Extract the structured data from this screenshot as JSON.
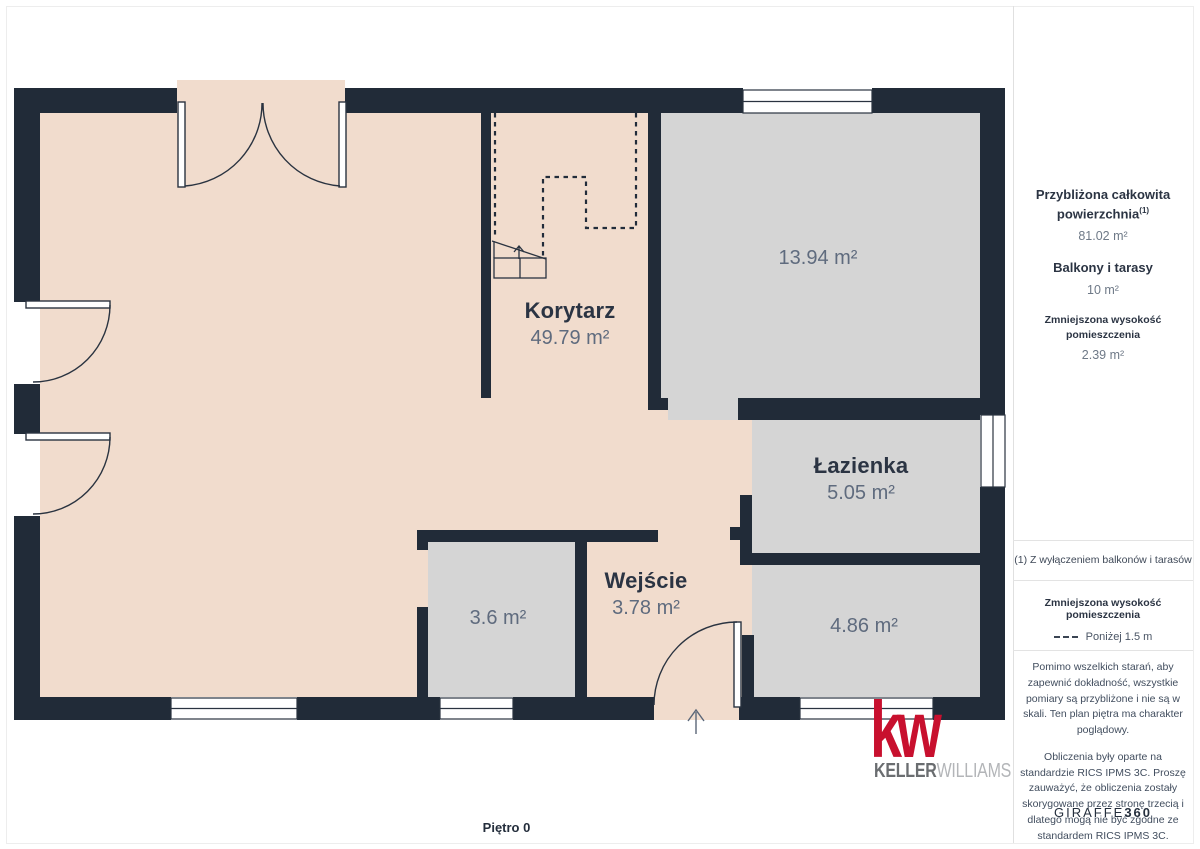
{
  "page": {
    "floor_label": "Piętro 0"
  },
  "plan": {
    "rooms": [
      {
        "name": "Korytarz",
        "area": "49.79 m²"
      },
      {
        "name": "",
        "area": "13.94 m²"
      },
      {
        "name": "Łazienka",
        "area": "5.05 m²"
      },
      {
        "name": "Wejście",
        "area": "3.78 m²"
      },
      {
        "name": "",
        "area": "3.6 m²"
      },
      {
        "name": "",
        "area": "4.86 m²"
      }
    ]
  },
  "sidebar": {
    "stats": [
      {
        "label": "Przybliżona całkowita powierzchnia",
        "sup": "(1)",
        "value": "81.02 m²"
      },
      {
        "label": "Balkony i tarasy",
        "sup": "",
        "value": "10 m²"
      },
      {
        "label": "Zmniejszona wysokość pomieszczenia",
        "sup": "",
        "value": "2.39 m²"
      }
    ],
    "footnote": "(1) Z wyłączeniem balkonów i tarasów",
    "legend": {
      "title": "Zmniejszona wysokość pomieszczenia",
      "dash_label": "Poniżej 1.5 m"
    },
    "disclaimers": [
      "Pomimo wszelkich starań, aby zapewnić dokładność, wszystkie pomiary są przybliżone i nie są w skali. Ten plan piętra ma charakter poglądowy.",
      "Obliczenia były oparte na standardzie RICS IPMS 3C. Proszę zauważyć, że obliczenia zostały skorygowane przez stronę trzecią i dlatego mogą nie być zgodne ze standardem RICS IPMS 3C."
    ],
    "brand": {
      "name": "GIRAFFE",
      "suffix": "360"
    }
  },
  "logo": {
    "monogram": "kw",
    "brand_bold": "KELLER",
    "brand_light": "WILLIAMS"
  },
  "colors": {
    "wall": "#212b38",
    "floor_pink": "#f1dccd",
    "floor_gray": "#d5d5d5",
    "kw_red": "#c8102e",
    "text_dark": "#2b3443",
    "text_gray": "#5f6b7e"
  }
}
